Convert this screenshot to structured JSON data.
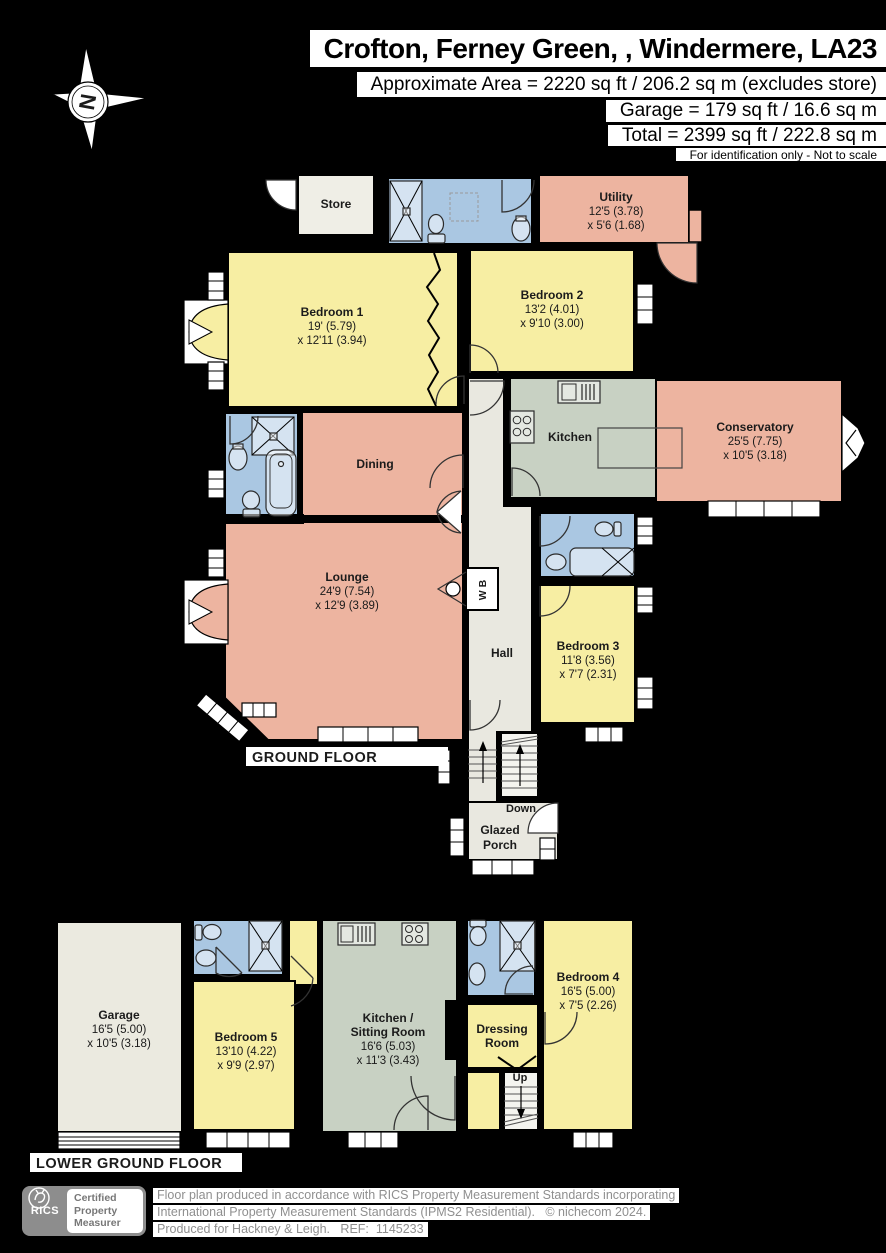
{
  "header": {
    "title": "Crofton, Ferney Green, , Windermere, LA23",
    "area_line": "Approximate Area = 2220 sq ft / 206.2 sq m (excludes store)",
    "garage_line": "Garage = 179 sq ft / 16.6 sq m",
    "total_line": "Total = 2399 sq ft / 222.8 sq m",
    "disclaimer": "For identification only - Not to scale",
    "compass_letter": "N"
  },
  "ground_floor": {
    "label": "GROUND FLOOR",
    "rooms": {
      "store": {
        "name": "Store"
      },
      "utility": {
        "name": "Utility",
        "dim1": "12'5 (3.78)",
        "dim2": "x 5'6 (1.68)"
      },
      "bedroom1": {
        "name": "Bedroom 1",
        "dim1": "19' (5.79)",
        "dim2": "x 12'11 (3.94)"
      },
      "bedroom2": {
        "name": "Bedroom 2",
        "dim1": "13'2 (4.01)",
        "dim2": "x 9'10 (3.00)"
      },
      "kitchen": {
        "name": "Kitchen"
      },
      "conservatory": {
        "name": "Conservatory",
        "dim1": "25'5 (7.75)",
        "dim2": "x 10'5 (3.18)"
      },
      "dining": {
        "name": "Dining"
      },
      "lounge": {
        "name": "Lounge",
        "dim1": "24'9 (7.54)",
        "dim2": "x 12'9 (3.89)"
      },
      "hall": {
        "name": "Hall"
      },
      "bedroom3": {
        "name": "Bedroom 3",
        "dim1": "11'8 (3.56)",
        "dim2": "x 7'7 (2.31)"
      },
      "wb": {
        "name": "W B"
      },
      "stairs": {
        "label": "Down"
      },
      "porch": {
        "name1": "Glazed",
        "name2": "Porch"
      }
    }
  },
  "lower_floor": {
    "label": "LOWER GROUND FLOOR",
    "rooms": {
      "garage": {
        "name": "Garage",
        "dim1": "16'5 (5.00)",
        "dim2": "x 10'5 (3.18)"
      },
      "bedroom5": {
        "name": "Bedroom 5",
        "dim1": "13'10 (4.22)",
        "dim2": "x 9'9 (2.97)"
      },
      "kitchen_sitting": {
        "name1": "Kitchen /",
        "name2": "Sitting Room",
        "dim1": "16'6 (5.03)",
        "dim2": "x 11'3 (3.43)"
      },
      "dressing": {
        "name1": "Dressing",
        "name2": "Room"
      },
      "bedroom4": {
        "name": "Bedroom 4",
        "dim1": "16'5 (5.00)",
        "dim2": "x 7'5 (2.26)"
      },
      "stairs": {
        "label": "Up"
      }
    }
  },
  "footer": {
    "logo": {
      "org": "RICS",
      "cert1": "Certified",
      "cert2": "Property",
      "cert3": "Measurer"
    },
    "line1": "Floor plan produced in accordance with RICS Property Measurement Standards incorporating",
    "line2": "International Property Measurement Standards (IPMS2 Residential).   © nichecom 2024.",
    "line3": "Produced for Hackney & Leigh.   REF:  1145233"
  },
  "colors": {
    "bedroom_yellow": "#f7eea3",
    "living_salmon": "#edb4a0",
    "bathroom_blue": "#aac7e2",
    "kitchen_green": "#c8d1c3",
    "hall_beige": "#e9e8e0",
    "store_grey": "#efeee6",
    "stair_white": "#f4f4ef",
    "wall_black": "#000000"
  }
}
